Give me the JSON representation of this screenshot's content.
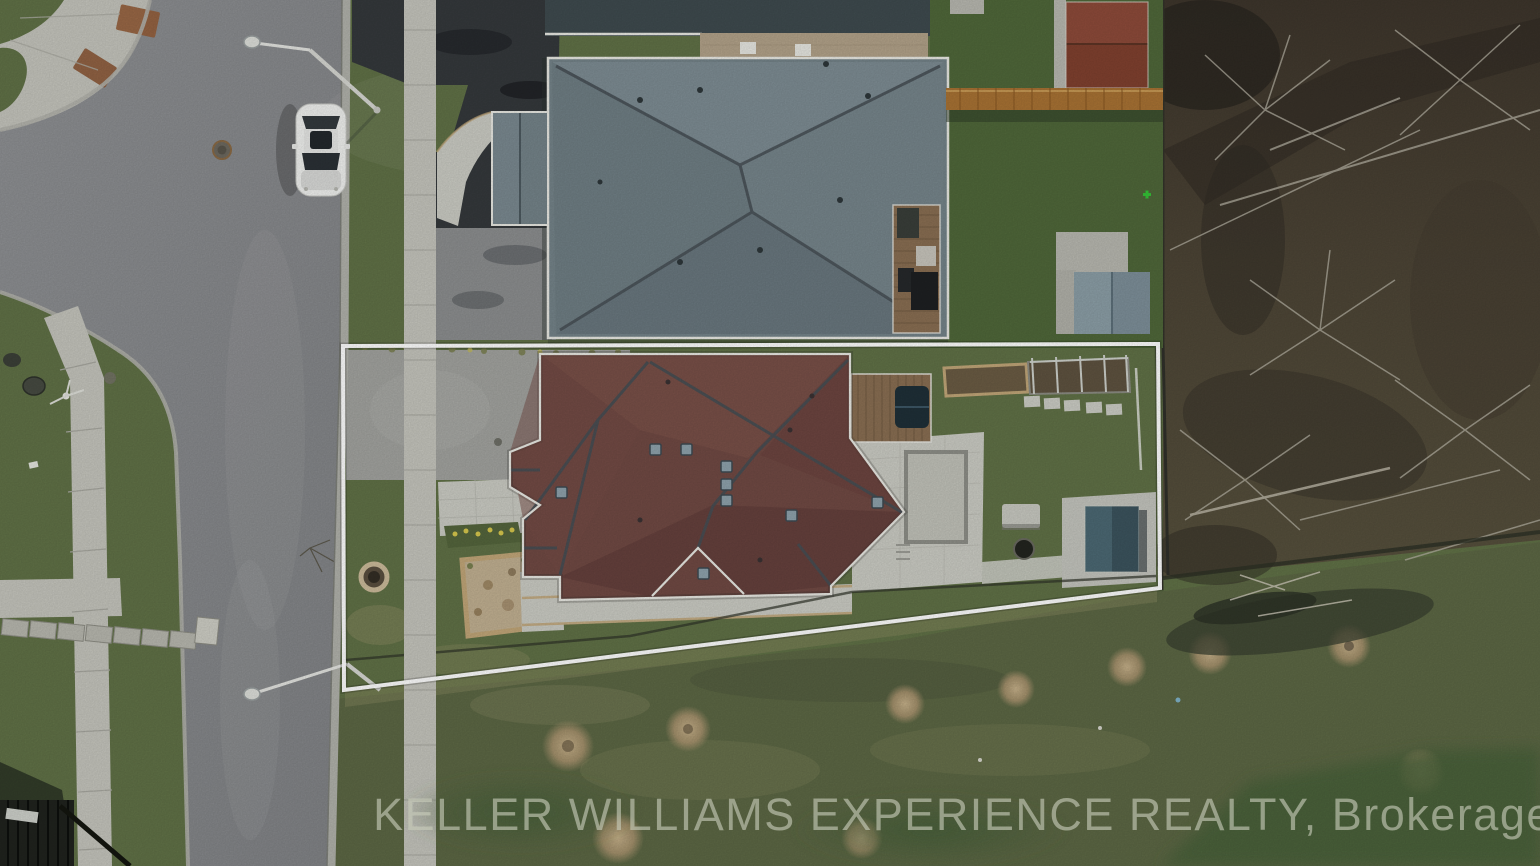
{
  "image": {
    "kind": "aerial-drone-real-estate-photo",
    "subject": "Top-down aerial view of a residential lot outlined in white, with dark-red hip-roof house, gray-roof neighbor house, street on left, bare woods on right"
  },
  "watermark": {
    "text": "KELLER WILLIAMS EXPERIENCE REALTY, Brokerage",
    "color": "#c9cdbb",
    "opacity": 0.62,
    "position": "bottom-center"
  },
  "property_outline": {
    "color": "#ffffff",
    "shape": "trapezoid",
    "corners_px": [
      [
        343,
        346
      ],
      [
        1158,
        344
      ],
      [
        1160,
        588
      ],
      [
        344,
        690
      ]
    ]
  },
  "objects": {
    "parked_car": "white sedan on street",
    "featured_house": "dark red-brown complex hip roof with skylights",
    "neighbor_house": "gray-green hip roof with tan brick upper section",
    "sheds": [
      "red-roof shed top right",
      "blue-gray shed",
      "dark teal garden shed"
    ],
    "hardscape": [
      "driveway",
      "public sidewalk",
      "paver patio",
      "wood deck",
      "garden beds",
      "fire pit ring",
      "stone bench"
    ],
    "street_lights": 2,
    "woods": "leafless brush and trees on right side",
    "field": "rough lawn with circular dirt patches at bottom"
  },
  "palette": {
    "street": "#87898c",
    "streetDark": "#6f7173",
    "gutter": "#b2b3ac",
    "sidewalk": "#c6c6be",
    "seam": "#a9a9a1",
    "grass": "#617247",
    "grassRich": "#50683a",
    "grassDry": "#8f8f63",
    "field": "#5d6845",
    "fieldDark": "#3d4733",
    "woods": "#4a4237",
    "woodsDark": "#2b2721",
    "branch": "#b7b3a5",
    "maroon": "#714a44",
    "maroonHi": "#7f554d",
    "maroonLo": "#5c3b38",
    "ridge": "#474f55",
    "grayRoof": "#75848a",
    "grayHi": "#87969d",
    "grayLo": "#5d6b72",
    "slate": "#3f4b4f",
    "brick": "#b3a38a",
    "fascia": "#eaeae4",
    "paver": "#cccdc5",
    "tan": "#c2a779",
    "deck": "#8a6f53",
    "driveDark": "#35393c",
    "driveGray": "#a3a4a0",
    "shedRed": "#81412f",
    "shedBlue": "#7e909a",
    "shedTeal": "#3c545e",
    "fenceOrange": "#a97334",
    "dirt": "#9c8a67",
    "dirtLight": "#c2b192",
    "outline": "#ffffff",
    "watermark": "#c9cdbb",
    "carBody": "#f1f2f0",
    "darkFence": "#20231e",
    "hotTub": "#1f3038"
  }
}
